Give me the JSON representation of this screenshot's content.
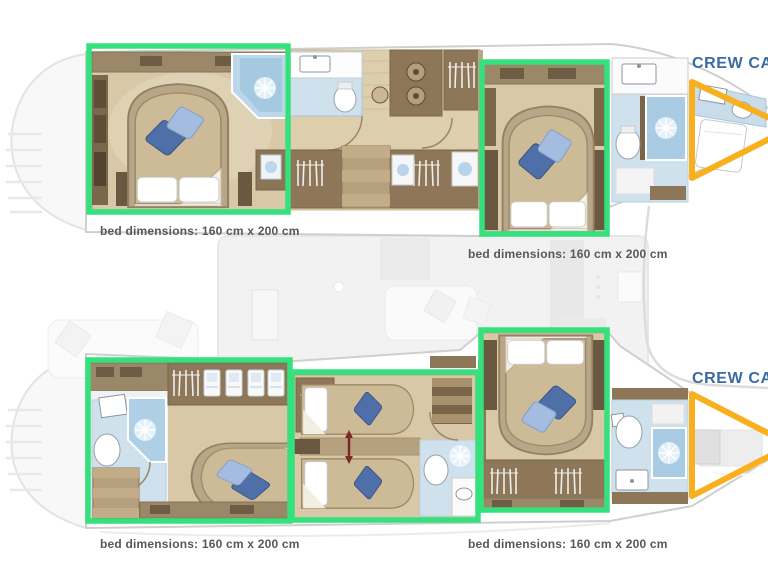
{
  "colors": {
    "highlight_green": "#35E17C",
    "highlight_orange": "#F8B01E",
    "crew_label": "#3A6BA3",
    "dimension_label": "#55585C"
  },
  "labels": {
    "bed_dimensions": [
      {
        "position": "below-top-left-cabin",
        "text": "bed dimensions: 160 cm x 200 cm"
      },
      {
        "position": "below-top-right-cabin",
        "text": "bed dimensions: 160 cm x 200 cm"
      },
      {
        "position": "below-bottom-left-cabin",
        "text": "bed dimensions: 160 cm x 200 cm"
      },
      {
        "position": "below-bottom-right-cabin",
        "text": "bed dimensions: 160 cm x 200 cm"
      }
    ],
    "crew_cabins": [
      {
        "position": "top-right-bow",
        "text": "CREW CABIN"
      },
      {
        "position": "middle-right-bow",
        "text": "CREW CABIN"
      }
    ]
  }
}
